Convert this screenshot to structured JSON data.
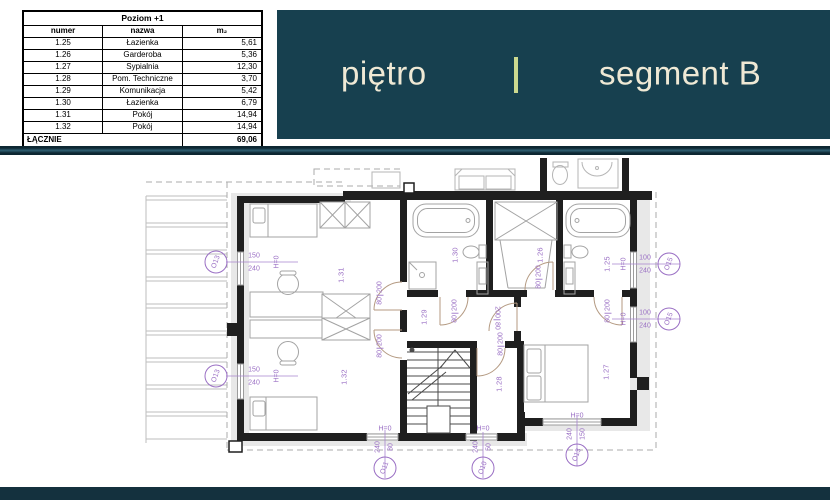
{
  "table": {
    "title": "Poziom +1",
    "columns": [
      "numer",
      "nazwa",
      "m₂"
    ],
    "rows": [
      [
        "1.25",
        "Łazienka",
        "5,61"
      ],
      [
        "1.26",
        "Garderoba",
        "5,36"
      ],
      [
        "1.27",
        "Sypialnia",
        "12,30"
      ],
      [
        "1.28",
        "Pom. Techniczne",
        "3,70"
      ],
      [
        "1.29",
        "Komunikacja",
        "5,42"
      ],
      [
        "1.30",
        "Łazienka",
        "6,79"
      ],
      [
        "1.31",
        "Pokój",
        "14,94"
      ],
      [
        "1.32",
        "Pokój",
        "14,94"
      ]
    ],
    "total_label": "ŁĄCZNIE",
    "total_value": "69,06"
  },
  "banner": {
    "left": "piętro",
    "separator": "|",
    "right": "segment B"
  },
  "colors": {
    "banner_bg": "#17404f",
    "banner_text": "#efe9d5",
    "separator": "#ccd98f",
    "annotation": "#9a6fc4",
    "wall": "#1f1f1f",
    "door_arc": "#b49a82",
    "bottom_bar": "#14313e"
  },
  "plan": {
    "rooms": [
      {
        "id": "1.25",
        "x": 607,
        "y": 264
      },
      {
        "id": "1.26",
        "x": 540,
        "y": 255
      },
      {
        "id": "1.27",
        "x": 606,
        "y": 372
      },
      {
        "id": "1.28",
        "x": 499,
        "y": 384
      },
      {
        "id": "1.29",
        "x": 424,
        "y": 317
      },
      {
        "id": "1.30",
        "x": 455,
        "y": 255
      },
      {
        "id": "1.31",
        "x": 341,
        "y": 275
      },
      {
        "id": "1.32",
        "x": 344,
        "y": 377
      }
    ],
    "doors": [
      {
        "t": "80",
        "b": "200",
        "x": 380,
        "y": 293,
        "flip": false
      },
      {
        "t": "80",
        "b": "200",
        "x": 380,
        "y": 346,
        "flip": false
      },
      {
        "t": "80",
        "b": "200",
        "x": 455,
        "y": 311,
        "flip": false
      },
      {
        "t": "80",
        "b": "200",
        "x": 539,
        "y": 277,
        "flip": false
      },
      {
        "t": "80",
        "b": "200",
        "x": 608,
        "y": 311,
        "flip": false
      },
      {
        "t": "80",
        "b": "200",
        "x": 501,
        "y": 344,
        "flip": false
      },
      {
        "t": "200",
        "b": "80",
        "x": 497,
        "y": 318,
        "flip": true
      }
    ],
    "windows": [
      {
        "id": "O13",
        "dim1": "150",
        "dim2": "240",
        "h": "H=0",
        "orient": "left",
        "x": 216,
        "y": 262
      },
      {
        "id": "O13",
        "dim1": "150",
        "dim2": "240",
        "h": "H=0",
        "orient": "left",
        "x": 216,
        "y": 376
      },
      {
        "id": "O15",
        "dim1": "100",
        "dim2": "240",
        "h": "H=0",
        "orient": "right",
        "x": 669,
        "y": 264
      },
      {
        "id": "O15",
        "dim1": "100",
        "dim2": "240",
        "h": "H=0",
        "orient": "right",
        "x": 669,
        "y": 319
      },
      {
        "id": "O11",
        "dim1": "80",
        "dim2": "240",
        "h": "H=0",
        "orient": "bottom",
        "x": 385,
        "y": 468
      },
      {
        "id": "O10",
        "dim1": "50",
        "dim2": "240",
        "h": "H=0",
        "orient": "bottom",
        "x": 483,
        "y": 468
      },
      {
        "id": "O13",
        "dim1": "150",
        "dim2": "240",
        "h": "H=0",
        "orient": "bottom",
        "x": 577,
        "y": 455
      }
    ]
  }
}
